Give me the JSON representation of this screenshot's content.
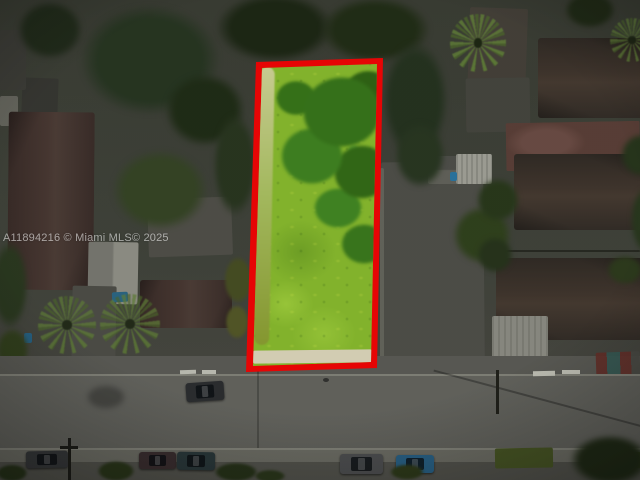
{
  "watermark": {
    "text": "A11894216 © Miami MLS© 2025"
  },
  "colors": {
    "lot_outline": "#e60505",
    "lot_grass": "#82b22c",
    "lot_canopy": "#36701b",
    "ground": "#45483e",
    "road": "#6c6c66",
    "sidewalk": "#62625c",
    "roof_brown": "#4a3733",
    "roof_dark": "#37302a",
    "tree_dark": "#27351f",
    "concrete_pad": "#55554f",
    "terracotta_pad": "#62443c",
    "car_blue": "#2d6b94",
    "watermark_color": "#ffffff"
  }
}
